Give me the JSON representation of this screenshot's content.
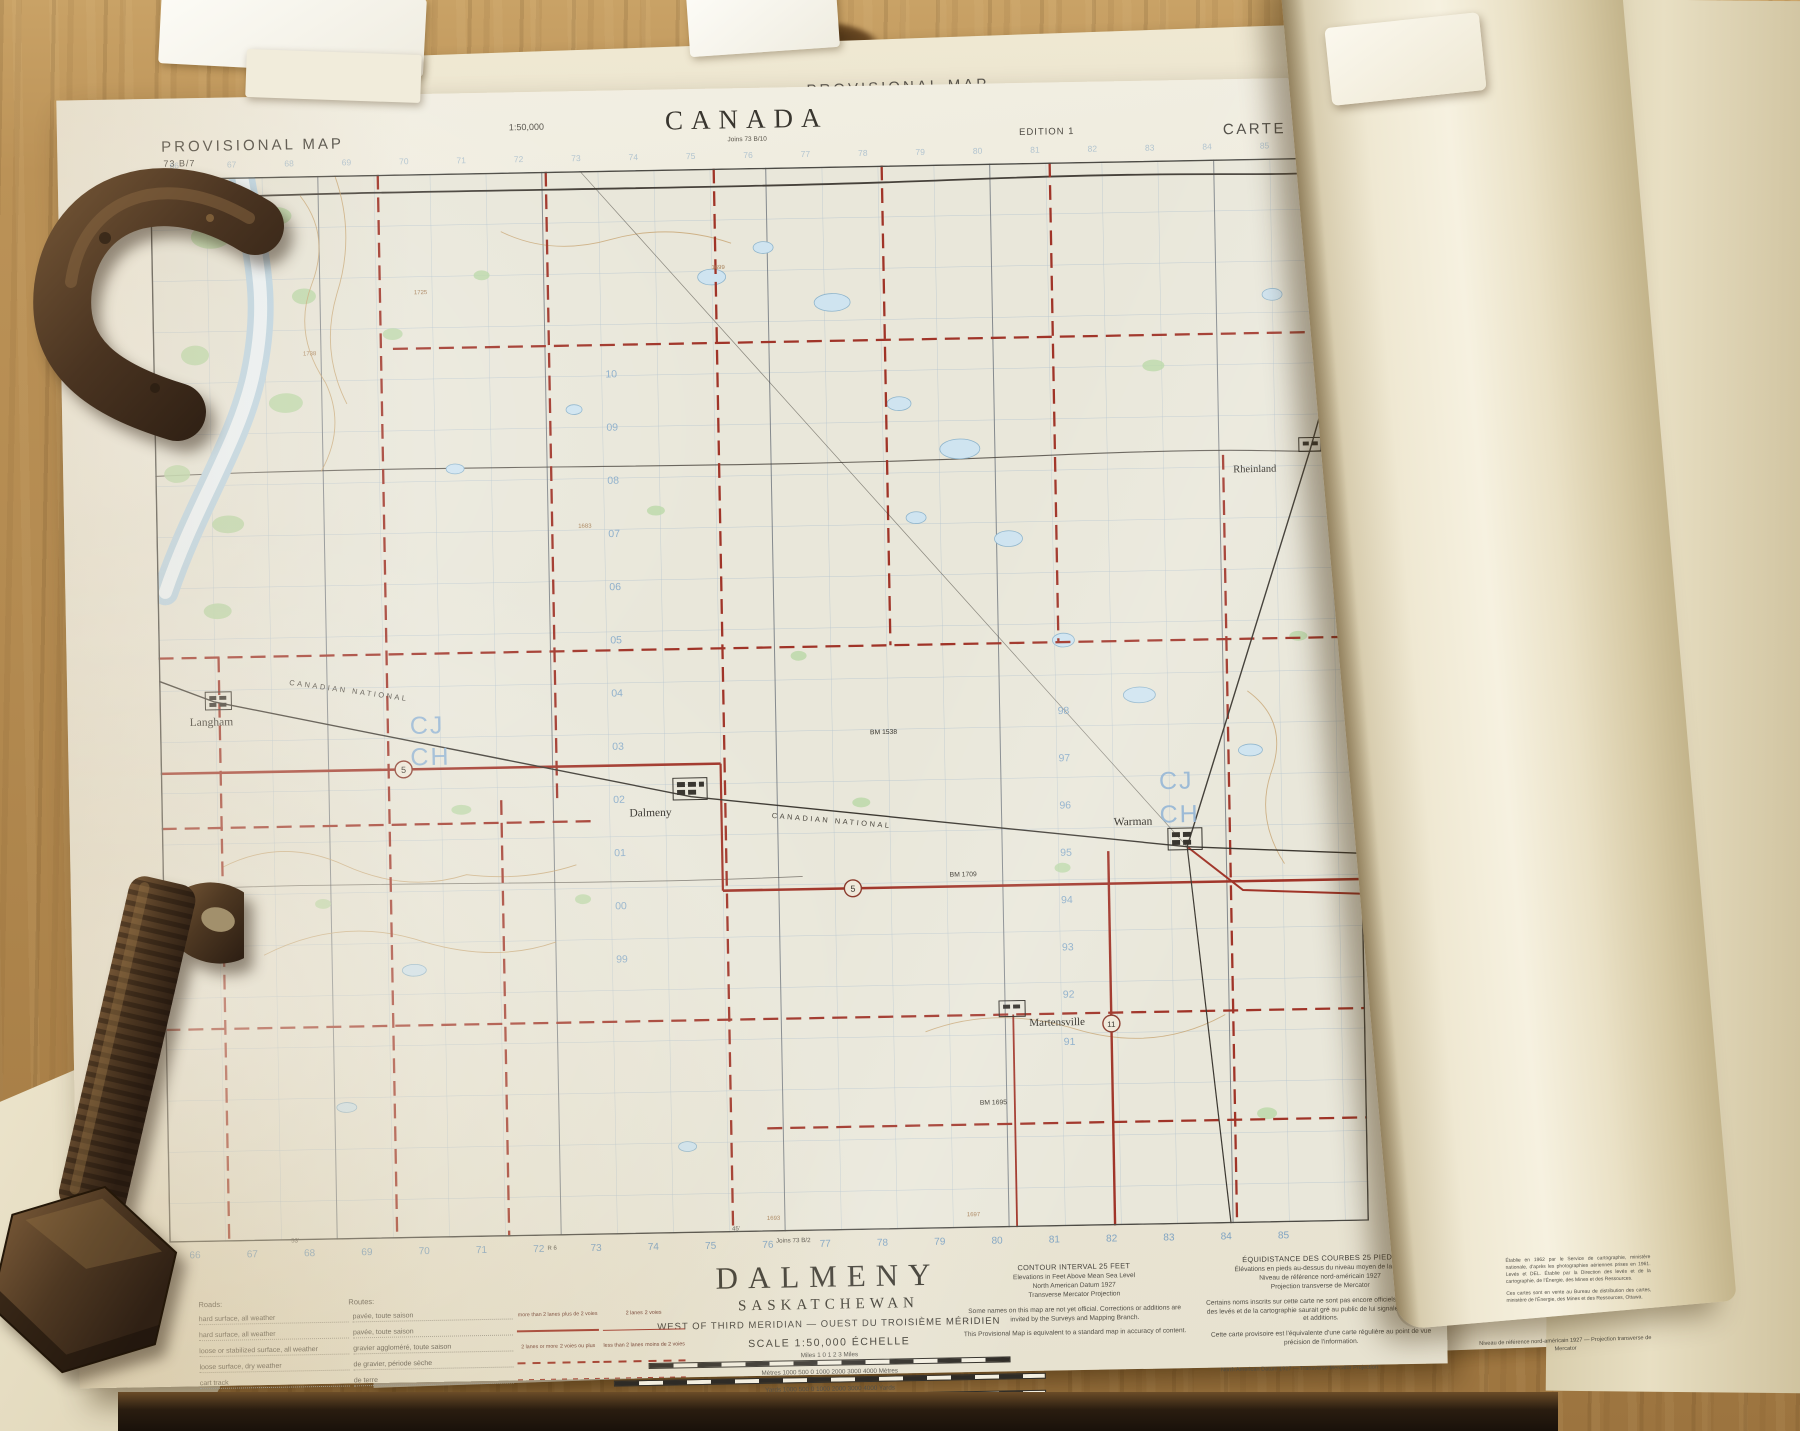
{
  "colors": {
    "paper": "#ece8da",
    "wood": "#b38a50",
    "road_red": "#a03428",
    "grid_blue": "#a9bccb",
    "number_blue": "#7fa3c2",
    "water_blue": "#cfe4f0",
    "veg_green": "#b9d8a6",
    "contour_brown": "#c7a470",
    "rust_dark": "#3d2b1b",
    "rust_light": "#8a6742"
  },
  "sheet": {
    "top_left_title": "PROVISIONAL MAP",
    "sheet_number": "73 B/7",
    "top_scale": "1:50,000",
    "country": "CANADA",
    "joins_top": "Joins 73 B/10",
    "edition": "EDITION 1",
    "top_right_title": "CARTE PROVISOIRE",
    "corner_tl": {
      "lon": "107°00'",
      "lat": "52°30'",
      "tp": "Tp 41"
    },
    "corner_tr": {
      "lon": "106°30'",
      "lat": "52°30'",
      "tp": "Tp 41"
    }
  },
  "title_block": {
    "minutes_mark": "45'",
    "joins_bottom": "Joins 73 B/2",
    "title": "DALMENY",
    "province": "SASKATCHEWAN",
    "meridian_en": "WEST OF THIRD MERIDIAN",
    "meridian_sep": "—",
    "meridian_fr": "OUEST DU TROISIÈME MÉRIDIEN",
    "scale_line": "SCALE 1:50,000 ÉCHELLE",
    "bar_miles": "Miles 1 0 1 2 3 Miles",
    "bar_metres": "Mètres 1000 500 0 1000 2000 3000 4000 Mètres",
    "bar_yards": "Yards 1000 500 0 1000 2000 3000 4000 Yards"
  },
  "road_legend": {
    "heading_en": "Roads:",
    "heading_fr": "Routes:",
    "rows": [
      {
        "en": "hard surface, all weather",
        "fr": "pavée, toute saison"
      },
      {
        "en": "hard surface, all weather",
        "fr": "pavée, toute saison"
      },
      {
        "en": "loose or stabilized surface, all weather",
        "fr": "gravier aggloméré, toute saison"
      },
      {
        "en": "loose surface, dry weather",
        "fr": "de gravier, période sèche"
      },
      {
        "en": "cart track",
        "fr": "de terre"
      },
      {
        "en": "trail or portage",
        "fr": "sentier ou portage"
      }
    ],
    "lane_labels": [
      {
        "en": "more than 2 lanes",
        "fr": "plus de 2 voies"
      },
      {
        "en": "2 lanes",
        "fr": "2 voies"
      },
      {
        "en": "2 lanes or more",
        "fr": "2 voies ou plus"
      },
      {
        "en": "less than 2 lanes",
        "fr": "moins de 2 voies"
      }
    ]
  },
  "notes_en": {
    "title": "CONTOUR INTERVAL 25 FEET",
    "line1": "Elevations in Feet Above Mean Sea Level",
    "line2": "North American Datum 1927",
    "line3": "Transverse Mercator Projection",
    "para1": "Some names on this map are not yet official. Corrections or additions are invited by the Surveys and Mapping Branch.",
    "para2": "This Provisional Map is equivalent to a standard map in accuracy of content."
  },
  "notes_fr": {
    "title": "ÉQUIDISTANCE DES COURBES 25 PIEDS",
    "line1": "Élévations en pieds au-dessus du niveau moyen de la mer",
    "line2": "Niveau de référence nord-américain 1927",
    "line3": "Projection transverse de Mercator",
    "para1": "Certains noms inscrits sur cette carte ne sont pas encore officiels. La Direction des levés et de la cartographie saurait gré au public de lui signaler corrections et additions.",
    "para2": "Cette carte provisoire est l'équivalente d'une carte régulière au point de vue précision de l'information."
  },
  "imprint": {
    "para1": "Établie en 1962 par le Service de cartographie, ministère nationale, d'après les photographies aériennes prises en 1961. Levés et DEL. Établie par la Direction des levés et de la cartographie, de l'Énergie, des Mines et des Ressources.",
    "para2": "Ces cartes sont en vente au Bureau de distribution des cartes, ministère de l'Énergie, des Mines et des Ressources, Ottawa."
  },
  "under_sheet": {
    "note_en": "North American Datum 1927 — Transverse Mercator Projection",
    "note_fr": "Niveau de référence nord-américain 1927 — Projection transverse de Mercator"
  },
  "map": {
    "towns": [
      "Langham",
      "Dalmeny",
      "Warman",
      "Martensville",
      "Rheinland"
    ],
    "railway_label": "CANADIAN NATIONAL",
    "shields": [
      "5",
      "5",
      "11"
    ],
    "benchmarks": [
      "BM 1709",
      "BM 1695",
      "BM 1538"
    ],
    "zone_a": "CJ",
    "zone_b": "CH",
    "eastings": [
      "66",
      "67",
      "68",
      "69",
      "70",
      "71",
      "72",
      "73",
      "74",
      "75",
      "76",
      "77",
      "78",
      "79",
      "80",
      "81",
      "82",
      "83",
      "84",
      "85"
    ],
    "range_w": "R 7",
    "range_e": "R 6",
    "minute_53": "53'",
    "northings_col1": [
      "10",
      "09",
      "08",
      "07",
      "06",
      "05",
      "04",
      "03",
      "02",
      "01",
      "00",
      "99"
    ],
    "northings_col2": [
      "98",
      "97",
      "96",
      "95",
      "94",
      "93",
      "92",
      "91"
    ],
    "spot_elevations": [
      "1738",
      "1725",
      "1699",
      "1683",
      "1693",
      "1697"
    ]
  }
}
